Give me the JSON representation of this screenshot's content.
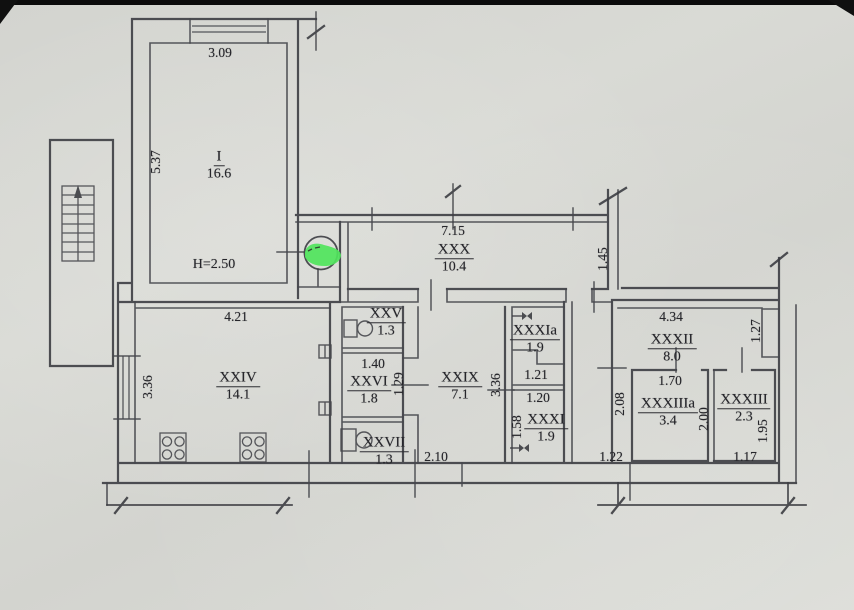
{
  "plan": {
    "note_height": "H=2.50",
    "stamp": {
      "highlight_color": "#4fe45c"
    },
    "rooms": [
      {
        "numeral": "I",
        "area": "16.6"
      },
      {
        "numeral": "XXX",
        "area": "10.4"
      },
      {
        "numeral": "XXIV",
        "area": "14.1"
      },
      {
        "numeral": "XXV",
        "area": "1.3"
      },
      {
        "numeral": "XXVI",
        "area": "1.8"
      },
      {
        "numeral": "XXVII",
        "area": "1.3"
      },
      {
        "numeral": "XXIX",
        "area": "7.1"
      },
      {
        "numeral": "XXXIa",
        "area": "1.9"
      },
      {
        "numeral": "XXXI",
        "area": "1.9"
      },
      {
        "numeral": "XXXII",
        "area": "8.0"
      },
      {
        "numeral": "XXXIIIa",
        "area": "3.4"
      },
      {
        "numeral": "XXXIII",
        "area": "2.3"
      }
    ],
    "dims": [
      {
        "value": "3.09"
      },
      {
        "value": "5.37"
      },
      {
        "value": "7.15"
      },
      {
        "value": "1.45"
      },
      {
        "value": "4.21"
      },
      {
        "value": "3.36"
      },
      {
        "value": "1.40"
      },
      {
        "value": "1.29"
      },
      {
        "value": "3.36"
      },
      {
        "value": "2.10"
      },
      {
        "value": "1.21"
      },
      {
        "value": "1.20"
      },
      {
        "value": "1.58"
      },
      {
        "value": "4.34"
      },
      {
        "value": "1.27"
      },
      {
        "value": "1.70"
      },
      {
        "value": "2.08"
      },
      {
        "value": "2.00"
      },
      {
        "value": "1.95"
      },
      {
        "value": "1.22"
      },
      {
        "value": "1.17"
      }
    ]
  }
}
